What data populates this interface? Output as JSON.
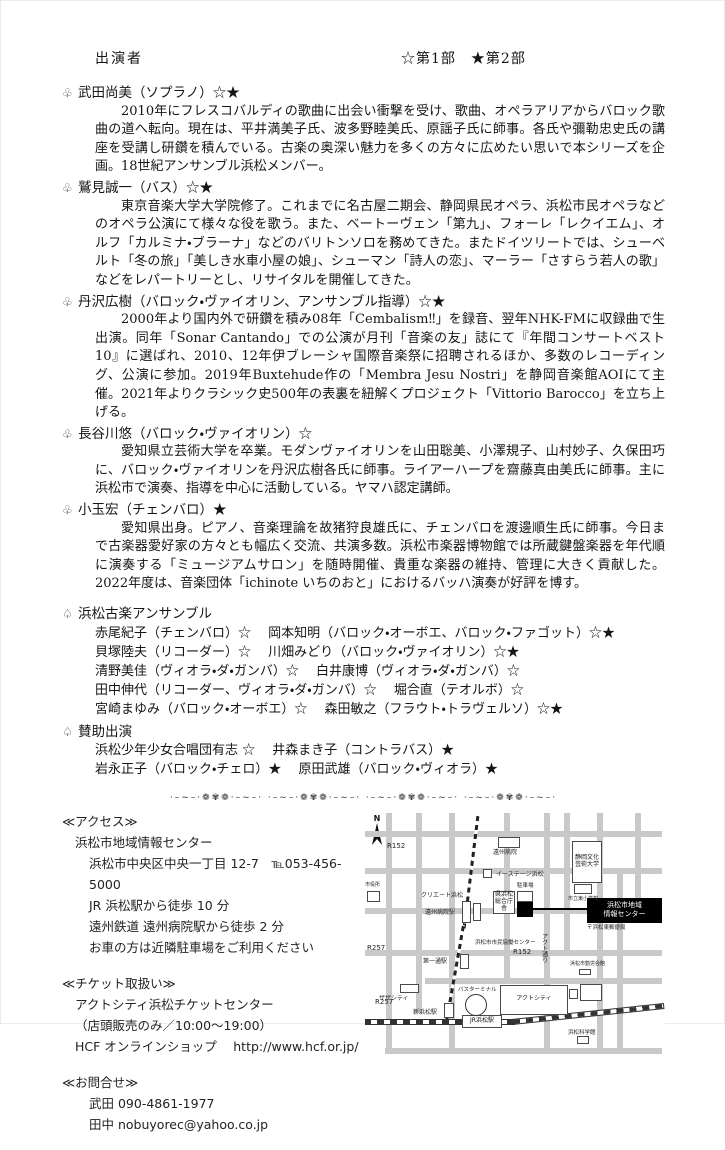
{
  "header": {
    "title": "出演者",
    "legend": "☆第1部　★第2部"
  },
  "performer_bullet": "♧",
  "group_bullet": "♤",
  "performers": [
    {
      "bullet": "♧",
      "name": "武田尚美（ソプラノ）☆★",
      "bio": "2010年にフレスコバルディの歌曲に出会い衝撃を受け、歌曲、オペラアリアからバロック歌曲の道へ転向。現在は、平井満美子氏、波多野睦美氏、原謡子氏に師事。各氏や彌勒忠史氏の講座を受講し研鑽を積んでいる。古楽の奥深い魅力を多くの方々に広めたい思いで本シリーズを企画。18世紀アンサンブル浜松メンバー。"
    },
    {
      "bullet": "♧",
      "name": "鷲見誠一（バス）☆★",
      "bio": "東京音楽大学大学院修了。これまでに名古屋二期会、静岡県民オペラ、浜松市民オペラなどのオペラ公演にて様々な役を歌う。また、ベートーヴェン「第九」、フォーレ「レクイエム」、オルフ「カルミナ・ブラーナ」などのバリトンソロを務めてきた。またドイツリートでは、シューベルト「冬の旅」「美しき水車小屋の娘」、シューマン「詩人の恋」、マーラー「さすらう若人の歌」などをレパートリーとし、リサイタルを開催してきた。"
    },
    {
      "bullet": "♧",
      "name": "丹沢広樹（バロック・ヴァイオリン、アンサンブル指導）☆★",
      "bio": "2000年より国内外で研鑽を積み08年「Cembalism‼」を録音、翌年NHK-FMに収録曲で生出演。同年「Sonar Cantando」での公演が月刊「音楽の友」誌にて『年間コンサートベスト10』に選ばれ、2010、12年伊ブレーシャ国際音楽祭に招聘されるほか、多数のレコーディング、公演に参加。2019年Buxtehude作の「Membra Jesu Nostri」を静岡音楽館AOIにて主催。2021年よりクラシック史500年の表裏を紐解くプロジェクト「Vittorio Barocco」を立ち上げる。"
    },
    {
      "bullet": "♧",
      "name": "長谷川悠（バロック・ヴァイオリン）☆",
      "bio": "愛知県立芸術大学を卒業。モダンヴァイオリンを山田聡美、小澤規子、山村妙子、久保田巧に、バロック・ヴァイオリンを丹沢広樹各氏に師事。ライアーハープを齋藤真由美氏に師事。主に浜松市で演奏、指導を中心に活動している。ヤマハ認定講師。"
    },
    {
      "bullet": "♧",
      "name": "小玉宏（チェンバロ）★",
      "bio": "愛知県出身。ピアノ、音楽理論を故猪狩良雄氏に、チェンバロを渡邊順生氏に師事。今日まで古楽器愛好家の方々とも幅広く交流、共演多数。浜松市楽器博物館では所蔵鍵盤楽器を年代順に演奏する「ミュージアムサロン」を随時開催、貴重な楽器の維持、管理に大きく貢献した。2022年度は、音楽団体「ichinote いちのおと」におけるバッハ演奏が好評を博す。"
    }
  ],
  "ensemble": {
    "bullet": "♤",
    "title": "浜松古楽アンサンブル",
    "lines": [
      "赤尾紀子（チェンバロ）☆　 岡本知明（バロック・オーボエ、バロック・ファゴット）☆★",
      "貝塚陸夫（リコーダー）☆　 川畑みどり（バロック・ヴァイオリン）☆★",
      "清野美佳（ヴィオラ・ダ・ガンバ）☆　 白井康博（ヴィオラ・ダ・ガンバ）☆",
      "田中伸代（リコーダー、ヴィオラ・ダ・ガンバ）☆　 堀合直（テオルボ）☆",
      "宮崎まゆみ（バロック・オーボエ）☆　 森田敏之（フラウト・トラヴェルソ）☆★"
    ]
  },
  "guests": {
    "bullet": "♤",
    "title": "賛助出演",
    "lines": [
      "浜松少年少女合唱団有志 ☆　 井森まき子（コントラバス）★",
      "岩永正子（バロック・チェロ）★　 原田武雄（バロック・ヴィオラ）★"
    ]
  },
  "ornament_unit": "·–~–·❁✾❁·–~–·",
  "access": {
    "heading": "≪アクセス≫",
    "venue": "浜松市地域情報センター",
    "lines": [
      "浜松市中央区中央一丁目 12-7　℡053-456-5000",
      "JR 浜松駅から徒歩 10 分",
      "遠州鉄道 遠州病院駅から徒歩 2 分",
      "お車の方は近隣駐車場をご利用ください"
    ]
  },
  "tickets": {
    "heading": "≪チケット取扱い≫",
    "lines": [
      "アクトシティ浜松チケットセンター",
      "（店頭販売のみ／10:00〜19:00）",
      "HCF オンラインショップ　 http://www.hcf.or.jp/"
    ]
  },
  "contact": {
    "heading": "≪お問合せ≫",
    "lines": [
      "武田 090-4861-1977",
      "田中 nobuyorec@yahoo.co.jp"
    ]
  },
  "map": {
    "north": "N",
    "roads_h": [
      {
        "y": 18,
        "x": 0,
        "w": 297
      },
      {
        "y": 55,
        "x": 0,
        "w": 297
      },
      {
        "y": 95,
        "x": 0,
        "w": 297
      },
      {
        "y": 137,
        "x": 0,
        "w": 297
      },
      {
        "y": 165,
        "x": 60,
        "w": 237
      },
      {
        "y": 235,
        "x": 20,
        "w": 277
      }
    ],
    "roads_v": [
      {
        "x": 21,
        "y": 0,
        "h": 240
      },
      {
        "x": 51,
        "y": 0,
        "h": 200
      },
      {
        "x": 84,
        "y": 0,
        "h": 240
      },
      {
        "x": 139,
        "y": 0,
        "h": 170
      },
      {
        "x": 179,
        "y": 0,
        "h": 240
      },
      {
        "x": 199,
        "y": 0,
        "h": 140
      },
      {
        "x": 232,
        "y": 0,
        "h": 240
      },
      {
        "x": 252,
        "y": 55,
        "h": 185
      },
      {
        "x": 270,
        "y": 0,
        "h": 100
      }
    ],
    "labels": [
      {
        "t": "R152",
        "x": 22,
        "y": 30,
        "s": 7
      },
      {
        "t": "遠州病院",
        "x": 128,
        "y": 37,
        "s": 6
      },
      {
        "t": "イーステージ浜松",
        "x": 131,
        "y": 59,
        "s": 6
      },
      {
        "t": "クリエート浜松",
        "x": 56,
        "y": 80,
        "s": 6
      },
      {
        "t": "遠州病院駅",
        "x": 60,
        "y": 97,
        "s": 6
      },
      {
        "t": "駐車場",
        "x": 152,
        "y": 70,
        "s": 5.5
      },
      {
        "t": "市立東小学校",
        "x": 203,
        "y": 84,
        "s": 5
      },
      {
        "t": "〒浜松東郵便局",
        "x": 222,
        "y": 112,
        "s": 5.5
      },
      {
        "t": "浜松市市民協働センター",
        "x": 110,
        "y": 127,
        "s": 5.5
      },
      {
        "t": "R152",
        "x": 148,
        "y": 136,
        "s": 7
      },
      {
        "t": "R257",
        "x": 2,
        "y": 132,
        "s": 7
      },
      {
        "t": "R257",
        "x": 10,
        "y": 186,
        "s": 7
      },
      {
        "t": "アクト通り",
        "x": 175,
        "y": 120,
        "s": 6,
        "vert": true
      },
      {
        "t": "浜松市勤労会館",
        "x": 205,
        "y": 149,
        "s": 5
      },
      {
        "t": "第一通駅",
        "x": 58,
        "y": 146,
        "s": 6
      },
      {
        "t": "ザザシティ",
        "x": 14,
        "y": 183,
        "s": 6
      },
      {
        "t": "新浜松駅",
        "x": 48,
        "y": 197,
        "s": 6
      },
      {
        "t": "バスターミナル",
        "x": 93,
        "y": 174,
        "s": 5.5
      },
      {
        "t": "浜松科学館",
        "x": 203,
        "y": 217,
        "s": 5.5
      },
      {
        "t": "市役所",
        "x": 0,
        "y": 70,
        "s": 5
      }
    ],
    "buildings": [
      {
        "x": 133,
        "y": 24,
        "w": 22,
        "h": 11
      },
      {
        "x": 118,
        "y": 56,
        "w": 9,
        "h": 9
      },
      {
        "x": 207,
        "y": 28,
        "w": 30,
        "h": 42,
        "t": "静岡文化\n芸術大学"
      },
      {
        "x": 97,
        "y": 88,
        "w": 9,
        "h": 22
      },
      {
        "x": 108,
        "y": 90,
        "w": 8,
        "h": 18
      },
      {
        "x": 209,
        "y": 71,
        "w": 18,
        "h": 10
      },
      {
        "x": 128,
        "y": 78,
        "w": 22,
        "h": 23,
        "t": "県浜松\n総合庁舎"
      },
      {
        "x": 152,
        "y": 78,
        "w": 16,
        "h": 11
      },
      {
        "x": 95,
        "y": 141,
        "w": 9,
        "h": 15
      },
      {
        "x": 79,
        "y": 190,
        "w": 10,
        "h": 15
      },
      {
        "x": 35,
        "y": 171,
        "w": 19,
        "h": 9
      },
      {
        "x": 135,
        "y": 172,
        "w": 68,
        "h": 30,
        "t": "アクトシティ"
      },
      {
        "x": 204,
        "y": 176,
        "w": 9,
        "h": 10
      },
      {
        "x": 215,
        "y": 171,
        "w": 22,
        "h": 17
      },
      {
        "x": 97,
        "y": 202,
        "w": 40,
        "h": 13,
        "t": "JR浜松駅"
      },
      {
        "x": 212,
        "y": 223,
        "w": 12,
        "h": 8
      },
      {
        "x": 214,
        "y": 156,
        "w": 12,
        "h": 6
      },
      {
        "x": 2,
        "y": 78,
        "w": 13,
        "h": 11
      }
    ],
    "blackbox": {
      "x": 152,
      "y": 89,
      "w": 16,
      "h": 15
    },
    "leader": {
      "x": 168,
      "y": 95,
      "w": 54
    },
    "highlight": {
      "x": 222,
      "y": 85,
      "w": 75,
      "h": 25,
      "t": "浜松市地域\n情報センター"
    },
    "circle": {
      "x": 100,
      "y": 181,
      "d": 20
    },
    "enshu_rail": [
      {
        "x": 112,
        "y": -2,
        "len": 118,
        "rot": 7
      },
      {
        "x": 97,
        "y": 112,
        "len": 96,
        "rot": 10
      }
    ],
    "jr_rail": [
      {
        "x": -2,
        "y": 206,
        "w": 152,
        "rot": 0
      },
      {
        "x": 147,
        "y": 206,
        "w": 153,
        "rot": -6
      }
    ]
  }
}
